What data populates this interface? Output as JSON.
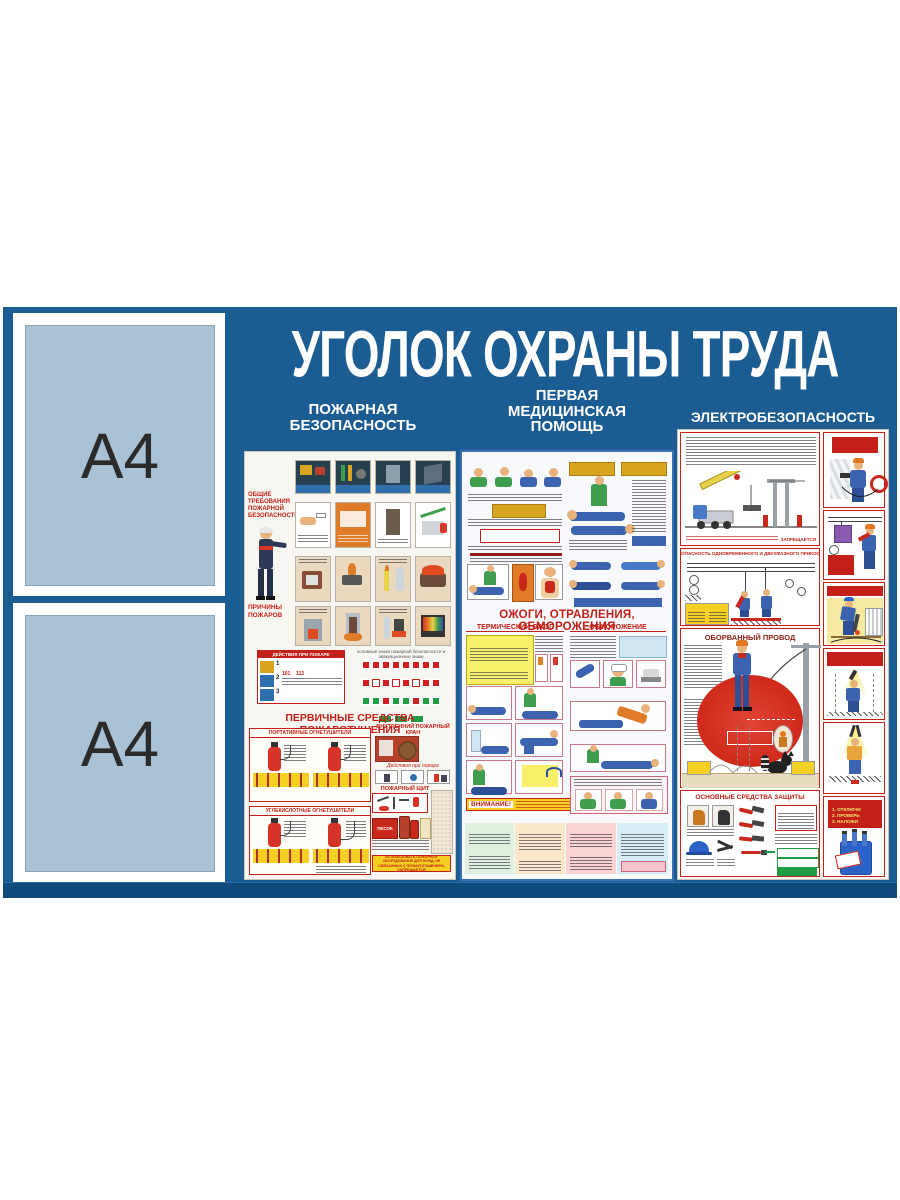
{
  "board": {
    "title": "УГОЛОК ОХРАНЫ ТРУДА",
    "colors": {
      "board_blue": "#1b5c92",
      "board_bottom_strip": "#0e4a7c",
      "pocket_blue": "#a9c2d5",
      "accent_red": "#c22018",
      "warning_yellow": "#f5d023",
      "sign_green": "#1f9d44",
      "tile_beige": "#ead9bf",
      "medical_frame_blue": "#3a6fb5"
    }
  },
  "pockets": [
    {
      "label": "А4"
    },
    {
      "label": "А4"
    }
  ],
  "sections": [
    {
      "id": "fire",
      "title_lines": [
        "ПОЖАРНАЯ",
        "БЕЗОПАСНОСТЬ"
      ]
    },
    {
      "id": "medical",
      "title_lines": [
        "ПЕРВАЯ",
        "МЕДИЦИНСКАЯ",
        "ПОМОЩЬ"
      ]
    },
    {
      "id": "electrical",
      "title_lines": [
        "ЭЛЕКТРОБЕЗОПАСНОСТЬ"
      ]
    }
  ],
  "fire_poster": {
    "general_requirements_label": "ОБЩИЕ ТРЕБОВАНИЯ ПОЖАРНОЙ БЕЗОПАСНОСТИ",
    "fire_causes_label": "ПРИЧИНЫ ПОЖАРОВ",
    "actions_header": "ДЕЙСТВИЯ ПРИ ПОЖАРЕ",
    "action_steps": [
      "1",
      "2",
      "3"
    ],
    "phone_1": "101",
    "phone_2": "112",
    "signs_caption": "основные знаки пожарной безопасности и эвакуационные знаки",
    "primary_means_title": "ПЕРВИЧНЫЕ СРЕДСТВА ПОЖАРОТУШЕНИЯ",
    "portable_extinguishers_label": "ПОРТАТИВНЫЕ ОГНЕТУШИТЕЛИ",
    "co2_extinguishers_label": "УГЛЕКИСЛОТНЫЕ ОГНЕТУШИТЕЛИ",
    "indoor_hydrant_label": "ВНУТРЕННИЙ ПОЖАРНЫЙ КРАН",
    "hydrant_subcaption": "Действия при пожаре",
    "fire_shield_label": "ПОЖАРНЫЙ ЩИТ",
    "sand_box_label": "ПЕСОК",
    "bottom_warning": "ИСПОЛЬЗОВАТЬ ПОЖАРНОЕ ОБОРУДОВАНИЕ ДЛЯ НУЖД, НЕ СВЯЗАННЫХ С ПОЖАРОТУШЕНИЕМ, ЗАПРЕЩАЕТСЯ"
  },
  "medical_poster": {
    "burns_title": "ОЖОГИ, ОТРАВЛЕНИЯ, ОБМОРОЖЕНИЯ",
    "thermal_burn_label": "ТЕРМИЧЕСКИЙ ОЖОГ",
    "frostbite_label": "ОБМОРОЖЕНИЕ",
    "attention_label": "ВНИМАНИЕ!"
  },
  "electrical_poster": {
    "two_phase_danger_label": "ОПАСНОСТЬ ОДНОВРЕМЕННОГО И ДВУХФАЗНОГО ПРИКОСНОВЕНИЯ",
    "prohibited_label": "ЗАПРЕЩАЕТСЯ",
    "broken_wire_label": "ОБОРВАННЫЙ ПРОВОД",
    "protection_means_label": "ОСНОВНЫЕ СРЕДСТВА ЗАЩИТЫ",
    "rules_lines": [
      "1. ОТКЛЮЧИ",
      "2. ПРОВЕРЬ",
      "3. НАЛОЖИ"
    ]
  }
}
